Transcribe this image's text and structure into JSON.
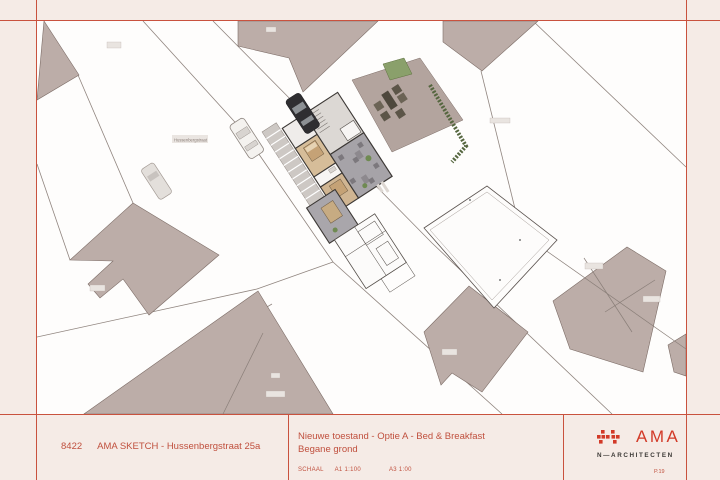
{
  "title_block": {
    "project_number": "8422",
    "project_title": "AMA SKETCH - Hussenbergstraat 25a",
    "drawing_title_line1": "Nieuwe toestand - Optie A - Bed & Breakfast",
    "drawing_title_line2": "Begane grond",
    "scale_label": "SCHAAL",
    "scale_a1": "A1 1:100",
    "scale_a3": "A3 1:00",
    "logo_text": "AMA",
    "logo_subtext": "N—ARCHITECTEN",
    "page_number": "P.19"
  },
  "map": {
    "street_label": "Hussenbergstraat",
    "colors": {
      "accent_red": "#c9523e",
      "page_background": "#f5ebe6",
      "drawing_background": "#fefdfc",
      "building_fill": "#bcada8",
      "parcel_line": "#90857f",
      "room_tan": "#d6bd99",
      "room_gray": "#a6a3a8",
      "terrace_mauve": "#b3a49e",
      "vegetation_green": "#6f8a52"
    }
  }
}
